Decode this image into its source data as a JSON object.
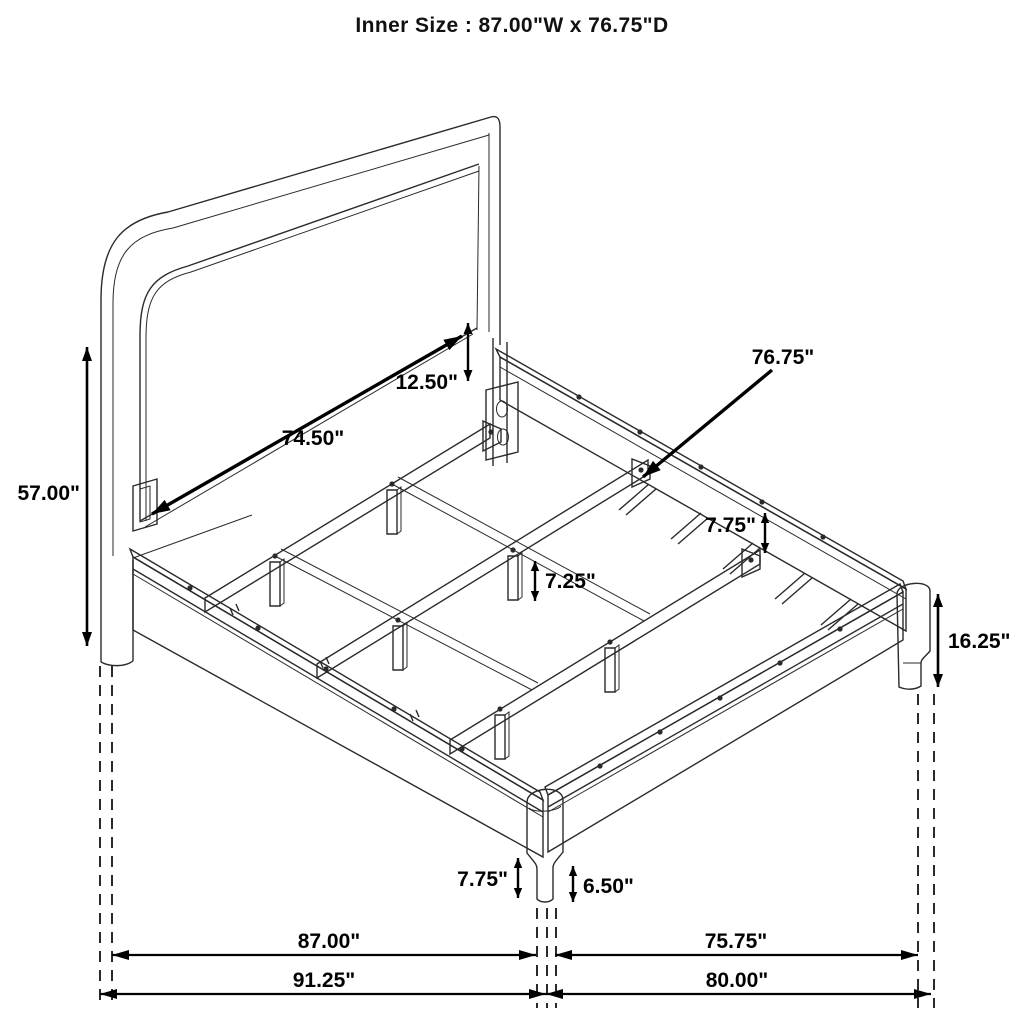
{
  "title": "Inner Size : 87.00\"W x 76.75\"D",
  "drawing": {
    "background": "#ffffff",
    "line_color": "#2a2a2a",
    "dim_color": "#000000",
    "units": "inches"
  },
  "dimensions": [
    {
      "id": "headboard-height",
      "label": "57.00\"",
      "type": "linear",
      "x1": 87,
      "y1": 347,
      "x2": 87,
      "y2": 646,
      "lx": 80,
      "ly": 500,
      "anchor": "end",
      "lw": 2.6,
      "hl": 14,
      "hw": 5
    },
    {
      "id": "headboard-panel-width",
      "label": "74.50\"",
      "type": "linear",
      "x1": 152,
      "y1": 514,
      "x2": 462,
      "y2": 336,
      "lx": 313,
      "ly": 445,
      "anchor": "middle",
      "lw": 3.4,
      "hl": 18,
      "hw": 6
    },
    {
      "id": "panel-to-rail-gap",
      "label": "12.50\"",
      "type": "linear",
      "x1": 468,
      "y1": 323,
      "x2": 468,
      "y2": 381,
      "lx": 458,
      "ly": 389,
      "anchor": "end",
      "lw": 2.4,
      "hl": 11,
      "hw": 4.5
    },
    {
      "id": "slat-rail-length",
      "label": "76.75\"",
      "type": "leader",
      "x1": 772,
      "y1": 370,
      "x2": 643,
      "y2": 477,
      "lx": 783,
      "ly": 364,
      "anchor": "middle",
      "lw": 3.4,
      "hl": 18,
      "hw": 6
    },
    {
      "id": "rear-rail-height",
      "label": "7.75\"",
      "type": "linear",
      "x1": 765,
      "y1": 513,
      "x2": 765,
      "y2": 553,
      "lx": 756,
      "ly": 532,
      "anchor": "end",
      "lw": 2.4,
      "hl": 10,
      "hw": 4.2
    },
    {
      "id": "center-leg-height",
      "label": "7.25\"",
      "type": "linear",
      "x1": 535,
      "y1": 561,
      "x2": 535,
      "y2": 601,
      "lx": 545,
      "ly": 588,
      "anchor": "start",
      "lw": 2.4,
      "hl": 10,
      "hw": 4.2
    },
    {
      "id": "footboard-height",
      "label": "16.25\"",
      "type": "linear",
      "x1": 938,
      "y1": 594,
      "x2": 938,
      "y2": 687,
      "lx": 948,
      "ly": 648,
      "anchor": "start",
      "lw": 2.6,
      "hl": 13,
      "hw": 5
    },
    {
      "id": "front-rail-height",
      "label": "7.75\"",
      "type": "linear",
      "x1": 518,
      "y1": 858,
      "x2": 518,
      "y2": 898,
      "lx": 508,
      "ly": 886,
      "anchor": "end",
      "lw": 2.4,
      "hl": 10,
      "hw": 4.2
    },
    {
      "id": "front-leg-height",
      "label": "6.50\"",
      "type": "linear",
      "x1": 573,
      "y1": 866,
      "x2": 573,
      "y2": 902,
      "lx": 583,
      "ly": 893,
      "anchor": "start",
      "lw": 2.4,
      "hl": 10,
      "hw": 4.2
    },
    {
      "id": "inner-width",
      "label": "87.00\"",
      "type": "linear",
      "x1": 112,
      "y1": 955,
      "x2": 536,
      "y2": 955,
      "lx": 329,
      "ly": 948,
      "anchor": "middle",
      "lw": 2.2,
      "hl": 17,
      "hw": 5
    },
    {
      "id": "inner-depth",
      "label": "75.75\"",
      "type": "linear",
      "x1": 555,
      "y1": 955,
      "x2": 918,
      "y2": 955,
      "lx": 736,
      "ly": 948,
      "anchor": "middle",
      "lw": 2.2,
      "hl": 17,
      "hw": 5
    },
    {
      "id": "outer-width",
      "label": "91.25\"",
      "type": "linear",
      "x1": 100,
      "y1": 994,
      "x2": 546,
      "y2": 994,
      "lx": 324,
      "ly": 987,
      "anchor": "middle",
      "lw": 2.2,
      "hl": 17,
      "hw": 5
    },
    {
      "id": "outer-depth",
      "label": "80.00\"",
      "type": "linear",
      "x1": 546,
      "y1": 994,
      "x2": 931,
      "y2": 994,
      "lx": 737,
      "ly": 987,
      "anchor": "middle",
      "lw": 2.2,
      "hl": 17,
      "hw": 5
    }
  ],
  "projection_lines": [
    {
      "id": "headboard-leg-outer",
      "x": 100,
      "y1": 666,
      "y2": 1008
    },
    {
      "id": "headboard-leg-inner",
      "x": 112,
      "y1": 666,
      "y2": 1008
    },
    {
      "id": "front-leg-left",
      "x": 537,
      "y1": 908,
      "y2": 1008
    },
    {
      "id": "front-leg-mid",
      "x": 547,
      "y1": 908,
      "y2": 1008
    },
    {
      "id": "front-leg-right",
      "x": 556,
      "y1": 908,
      "y2": 1008
    },
    {
      "id": "right-post-left",
      "x": 918,
      "y1": 694,
      "y2": 1008
    },
    {
      "id": "right-post-right",
      "x": 934,
      "y1": 694,
      "y2": 1008
    }
  ]
}
